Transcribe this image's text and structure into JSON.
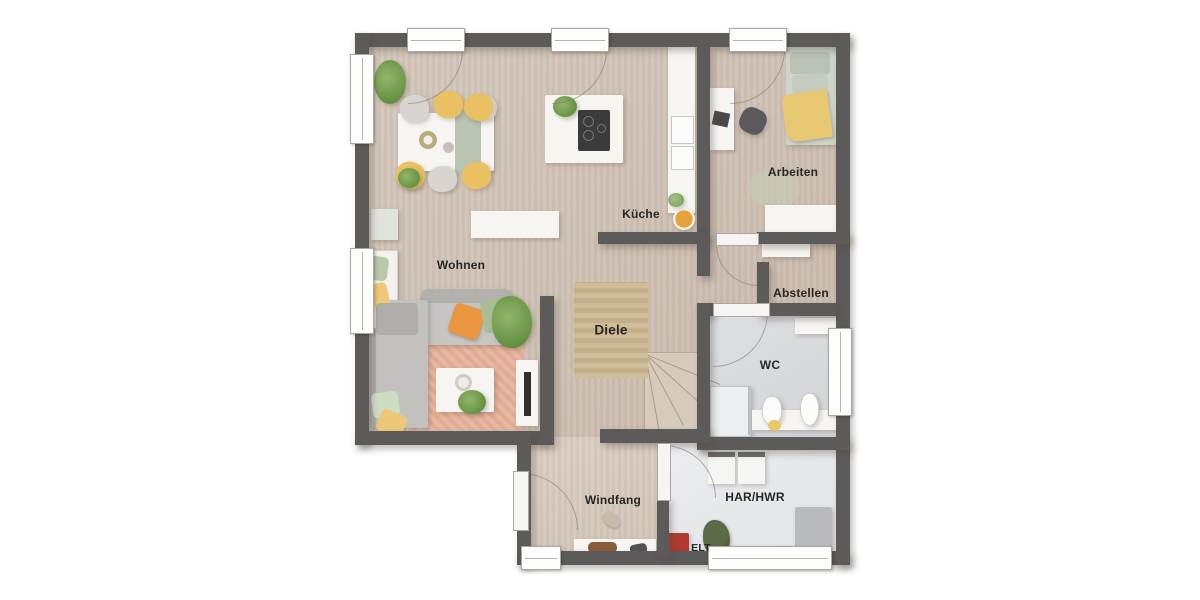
{
  "document": {
    "type": "floor-plan",
    "floor": "ground-floor"
  },
  "rooms": {
    "wohnen": {
      "label": "Wohnen"
    },
    "kueche": {
      "label": "Küche"
    },
    "arbeiten": {
      "label": "Arbeiten"
    },
    "abstellen": {
      "label": "Abstellen"
    },
    "diele": {
      "label": "Diele"
    },
    "wc": {
      "label": "WC"
    },
    "windfang": {
      "label": "Windfang"
    },
    "har_hwr": {
      "label": "HAR/HWR"
    },
    "elt": {
      "label": "ELT"
    }
  },
  "colors": {
    "wall": "#5d5b59",
    "floor_main": "#d0c2b5",
    "floor_windfang": "#d8ccbf",
    "floor_wc": "#d8dadc",
    "floor_har": "#e6e8ea",
    "rug_living": "#e5b39d",
    "rug_hall_jute": "#cbb894",
    "pillow_orange": "#e9963f",
    "pillow_green": "#a8bd96",
    "chair_yellow": "#e9c163",
    "elt_red": "#b03a30",
    "label_text": "#272727"
  }
}
